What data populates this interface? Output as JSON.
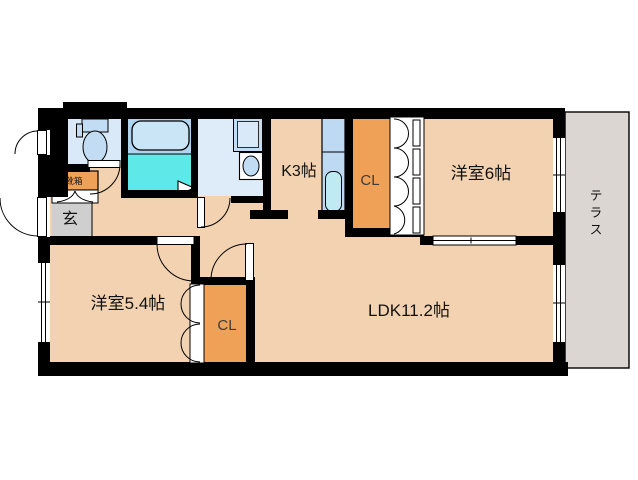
{
  "plan": {
    "title": "apartment-floorplan",
    "labels": {
      "kitchen": "K3帖",
      "closet_upper": "CL",
      "closet_lower": "CL",
      "room6": "洋室6帖",
      "room54": "洋室5.4帖",
      "ldk": "LDK11.2帖",
      "terrace": "テラス",
      "entrance": "玄",
      "shoebox": "靴箱"
    }
  },
  "colors": {
    "room_fill": "#F2D2B0",
    "closet_fill": "#F0A158",
    "wall": "#000000",
    "bath_floor": "#5FE8E8",
    "bath_surround": "#AFD4F0",
    "tub_fill": "#CAE5F6",
    "toilet_room": "#D9E9F8",
    "fixture_blue": "#C2DDF3",
    "washroom": "#DEEBF8",
    "counter_blue": "#BEDAF3",
    "sink_blue": "#BFEAF3",
    "entrance_gray": "#CFCFCF",
    "terrace_gray": "#DBD6D1",
    "label": "#111111"
  }
}
